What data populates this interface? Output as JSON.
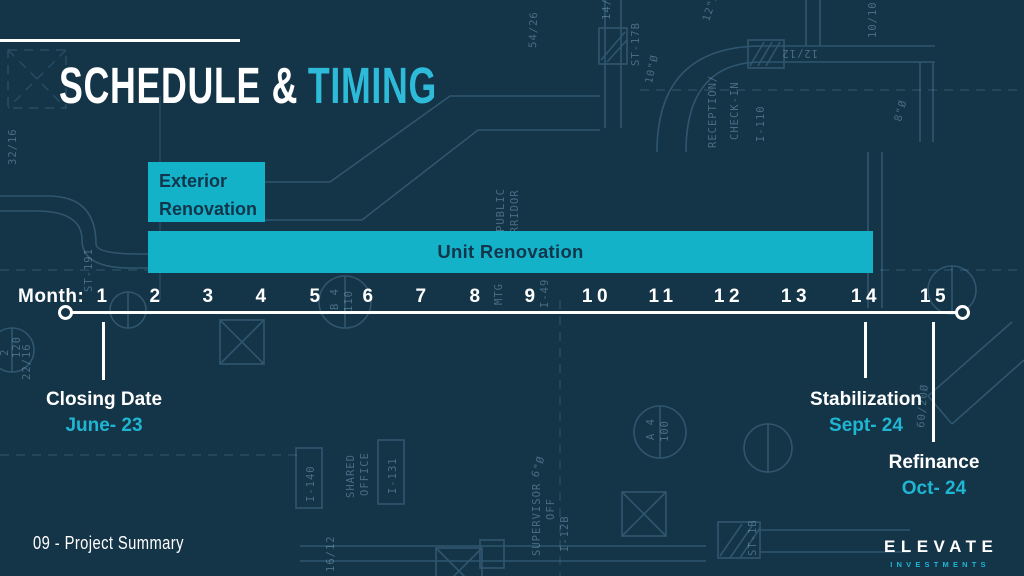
{
  "slide": {
    "title": {
      "white": "SCHEDULE &",
      "accent": "TIMING"
    },
    "footer": "09 - Project Summary",
    "logo": {
      "name": "ELEVATE",
      "sub": "INVESTMENTS"
    }
  },
  "timeline": {
    "axis_label": "Month:",
    "months": [
      "1",
      "2",
      "3",
      "4",
      "5",
      "6",
      "7",
      "8",
      "9",
      "10",
      "11",
      "12",
      "13",
      "14",
      "15"
    ],
    "bars": [
      {
        "label": "Exterior Renovation",
        "month_start": 2,
        "month_end": 4
      },
      {
        "label": "Unit Renovation",
        "month_start": 2,
        "month_end": 14
      }
    ],
    "milestones": [
      {
        "label": "Closing Date",
        "date": "June- 23",
        "month": 1
      },
      {
        "label": "Stabilization",
        "date": "Sept- 24",
        "month": 14
      },
      {
        "label": "Refinance",
        "date": "Oct- 24",
        "month": 15
      }
    ]
  },
  "colors": {
    "background": "#143447",
    "accent_fill": "#14B2C8",
    "accent_text": "#1FB6D3",
    "title_accent": "#2EBBDA",
    "text": "#FFFFFF",
    "blueprint_line": "#6FA6CC"
  },
  "bg": {
    "labels": [
      "54/26",
      "ST-17B",
      "10\"Ø",
      "14/1",
      "12\"Ø",
      "12/12",
      "10/10",
      "8\"Ø",
      "RECEPTION/",
      "CHECK-IN",
      "I-110",
      "32/16",
      "22/16",
      "ST-191",
      "MTG",
      "I-49",
      "PUBLIC",
      "CORRIDOR",
      "SHARED",
      "OFFICE",
      "I-131",
      "I-140",
      "SUPERVISOR",
      "OFF",
      "I-12B",
      "16/12",
      "ST-1B",
      "60/20Ø",
      "6\"Ø",
      "B 4",
      "110",
      "A 4",
      "100",
      "2",
      "120"
    ]
  }
}
